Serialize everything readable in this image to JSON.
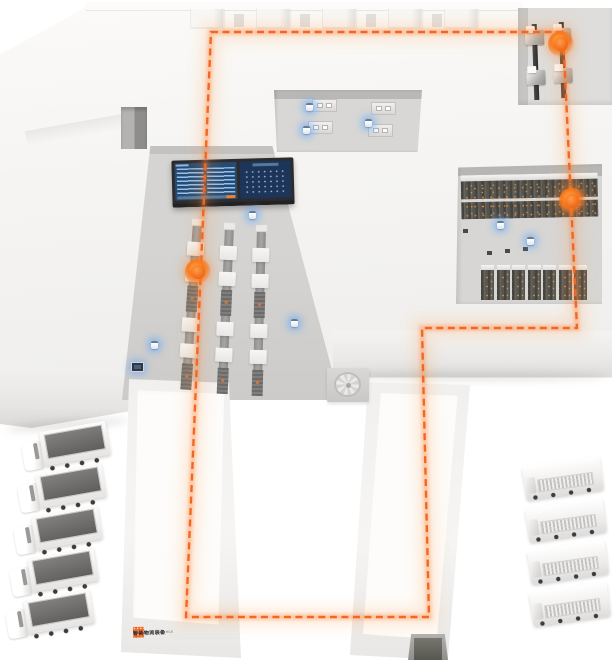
{
  "scene_title": "smart-warehouse-isometric-illustration",
  "colors": {
    "accent_orange": "#f26722",
    "glow_blue": "#58a6ff",
    "slab_light": "#f6f5f3",
    "recess_gray": "#d5d4d2",
    "dashboard_navy": "#274a70"
  },
  "route": {
    "color": "#f26722",
    "style": "dashed",
    "closed": true,
    "waypoints": [
      [
        211,
        32
      ],
      [
        563,
        32
      ],
      [
        577,
        328
      ],
      [
        422,
        328
      ],
      [
        429,
        617
      ],
      [
        186,
        617
      ]
    ]
  },
  "markers": [
    {
      "label": "machine-cell-stop",
      "x": 561,
      "y": 44
    },
    {
      "label": "rack-aisle-stop",
      "x": 572,
      "y": 201
    },
    {
      "label": "conveyor-stop",
      "x": 198,
      "y": 272
    }
  ],
  "agv_indicators": [
    [
      249,
      211
    ],
    [
      151,
      341
    ],
    [
      291,
      319
    ],
    [
      497,
      221
    ],
    [
      527,
      237
    ],
    [
      306,
      103
    ],
    [
      303,
      126
    ],
    [
      365,
      119
    ]
  ],
  "floor_monitor": {
    "x": 131,
    "y": 362
  },
  "roof_tabs": {
    "xs": [
      190,
      256,
      322,
      388,
      444
    ],
    "y": 8,
    "w": 34,
    "h": 20
  },
  "workstations": {
    "desks": [
      [
        312,
        99
      ],
      [
        308,
        121
      ],
      [
        371,
        102
      ],
      [
        368,
        124
      ]
    ]
  },
  "machines": {
    "columns": [
      [
        526,
        24
      ],
      [
        553,
        22
      ]
    ],
    "units_per_column": 2
  },
  "conveyors": {
    "lines": [
      {
        "x": 197,
        "y": 222,
        "tilt": 4
      },
      {
        "x": 229,
        "y": 226,
        "tilt": 2.5
      },
      {
        "x": 261,
        "y": 228,
        "tilt": 1.5
      }
    ],
    "length": 152,
    "station_offsets": [
      20,
      46,
      96,
      122
    ],
    "roller_offsets": [
      64,
      142
    ]
  },
  "racks": {
    "long": {
      "x": 461,
      "y": 174,
      "w": 137,
      "h": 44
    },
    "small": {
      "count": 7,
      "x": 481,
      "y": 265,
      "pitch": 15.5,
      "w": 13,
      "h": 35
    },
    "bins": [
      [
        463,
        229
      ],
      [
        487,
        251
      ],
      [
        505,
        249
      ],
      [
        523,
        247
      ]
    ]
  },
  "fleet": {
    "left_trucks": {
      "count": 5,
      "positions": [
        [
          22,
          428
        ],
        [
          18,
          470
        ],
        [
          14,
          512
        ],
        [
          10,
          554
        ],
        [
          6,
          596
        ]
      ]
    },
    "right_trucks": {
      "count": 4,
      "positions": [
        [
          524,
          461
        ],
        [
          527,
          503
        ],
        [
          529,
          545
        ],
        [
          531,
          587
        ]
      ]
    }
  },
  "logo": {
    "line1": "智能物流装备",
    "line2": "INTELLIGENT LOGISTICS"
  }
}
